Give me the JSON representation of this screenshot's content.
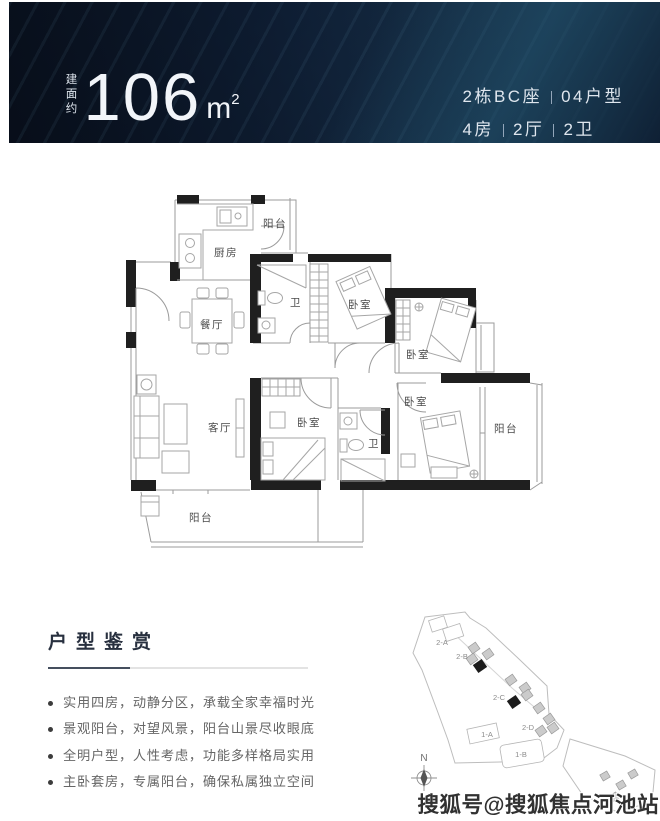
{
  "banner": {
    "area_prefix": "建面约",
    "area_value": "106",
    "area_unit": "m",
    "area_sup": "2",
    "unit_line": {
      "left": "2栋BC座",
      "right": "04户型"
    },
    "spec_line": {
      "items": [
        "4房",
        "2厅",
        "2卫"
      ]
    }
  },
  "floorplan": {
    "labels": {
      "kitchen": "厨房",
      "balcony_top": "阳台",
      "bath1": "卫",
      "dining": "餐厅",
      "bedroom_top": "卧室",
      "bedroom_right": "卧室",
      "bedroom_master": "卧室",
      "bedroom_mid": "卧室",
      "bath2": "卫",
      "living": "客厅",
      "balcony_right": "阳台",
      "balcony_bottom": "阳台"
    }
  },
  "features": {
    "title": "户型鉴赏",
    "items": [
      "实用四房，动静分区，承载全家幸福时光",
      "景观阳台，对望风景，阳台山景尽收眼底",
      "全明户型，人性考虑，功能多样格局实用",
      "主卧套房，专属阳台，确保私属独立空间"
    ]
  },
  "siteplan": {
    "compass": "N",
    "labels": [
      "2-A",
      "2-B",
      "2-C",
      "2-D",
      "1-A",
      "1-B"
    ]
  },
  "watermark": "搜狐号@搜狐焦点河池站",
  "colors": {
    "banner_navy": "#0e1e35",
    "banner_teal": "#1d4b63",
    "wall_black": "#1f1f1f",
    "line_gray": "#9b9b9b",
    "heading": "#28303f",
    "body_text": "#666666"
  }
}
